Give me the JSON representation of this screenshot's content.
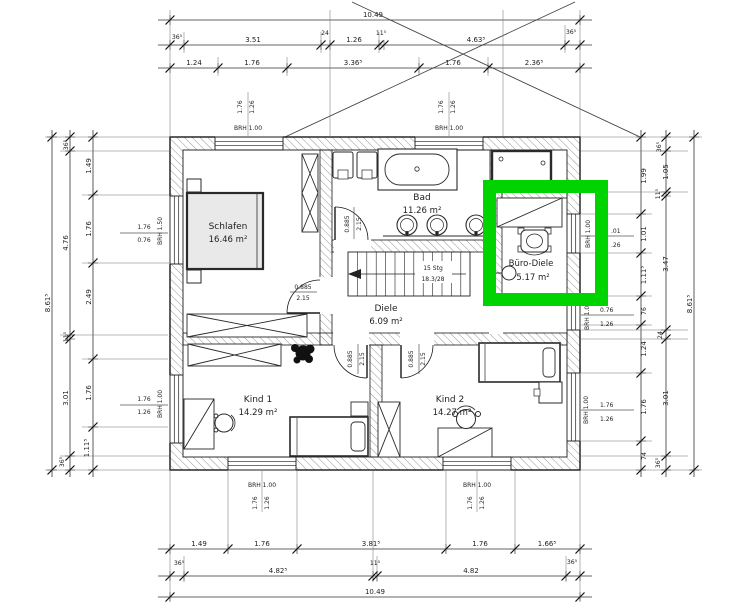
{
  "highlight": {
    "color": "#00d400",
    "target": "Büro-Diele"
  },
  "rooms": [
    {
      "name": "Schlafen",
      "area": "16.46 m²"
    },
    {
      "name": "Bad",
      "area": "11.26 m²"
    },
    {
      "name": "Büro-Diele",
      "area": "5.17 m²"
    },
    {
      "name": "Diele",
      "area": "6.09 m²"
    },
    {
      "name": "Kind 1",
      "area": "14.29 m²"
    },
    {
      "name": "Kind 2",
      "area": "14.27 m²"
    }
  ],
  "stairs": {
    "line1": "15 Stg",
    "line2": "18.3/28"
  },
  "door": {
    "w": "0.885",
    "h": "2.15"
  },
  "dims": {
    "top": {
      "total": "10.49",
      "chain2": [
        "36⁵",
        "3.51",
        "24",
        "1.26",
        "11⁵",
        "4.63⁵",
        "36⁵"
      ],
      "chain3": [
        "1.24",
        "1.76",
        "3.36⁵",
        "1.76",
        "2.36⁵"
      ]
    },
    "bottom": {
      "chain1": [
        "1.49",
        "1.76",
        "3.81⁵",
        "1.76",
        "1.66⁵"
      ],
      "chain2": [
        "36⁵",
        "4.82⁵",
        "11⁵",
        "4.82",
        "36⁵"
      ],
      "total": "10.49"
    },
    "left": {
      "total": "8.61⁵",
      "chain2": [
        "36⁵",
        "4.76",
        "11⁵",
        "3.01",
        "36⁵"
      ],
      "chain3": [
        "1.49",
        "1.76",
        "2.49",
        "1.76",
        "1.11⁵"
      ]
    },
    "right": {
      "total": "8.61⁵",
      "chain1": [
        "1.99",
        "1.01",
        "1.11⁵",
        "76",
        "1.24",
        "1.76",
        "74"
      ],
      "chain2": [
        "36⁵",
        "1.05",
        "11⁵",
        "3.47",
        "24",
        "3.01",
        "36⁵"
      ]
    }
  },
  "windows": {
    "top1": {
      "w": "1.76",
      "h": "1.26",
      "brh": "BRH 1.00"
    },
    "top2": {
      "w": "1.76",
      "h": "1.26",
      "brh": "BRH 1.00"
    },
    "left1": {
      "w": "1.76",
      "h": "0.76",
      "brh": "BRH 1.50"
    },
    "left2": {
      "w": "1.76",
      "h": "1.26",
      "brh": "BRH 1.00"
    },
    "right1": {
      "w": ".01",
      "h": ".26",
      "brh": "BRH 1.00"
    },
    "right2": {
      "w": "0.76",
      "h": "1.26",
      "brh": "BRH 1.00"
    },
    "right3": {
      "w": "1.76",
      "h": "1.26",
      "brh": "BRH 1.00"
    },
    "bottom1": {
      "w": "1.76",
      "h": "1.26",
      "brh": "BRH 1.00"
    },
    "bottom2": {
      "w": "1.76",
      "h": "1.26",
      "brh": "BRH 1.00"
    }
  }
}
